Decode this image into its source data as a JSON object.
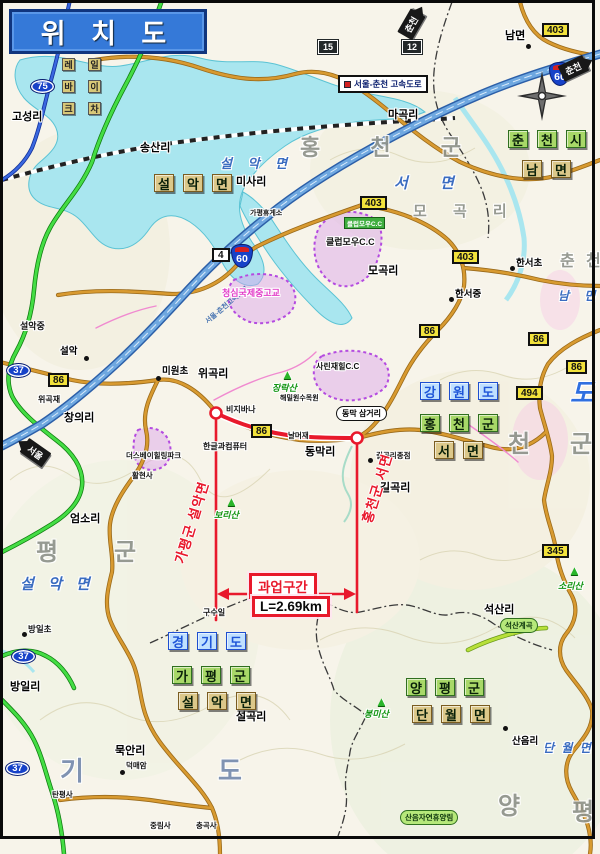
{
  "title": "위 치 도",
  "legend": {
    "expressway_label": "서울-춘천 고속도로",
    "expressway_inline": "서울-춘천고속도로"
  },
  "arrows": {
    "chuncheon": "춘천",
    "seoul": "서울"
  },
  "badges": {
    "n403": "403",
    "n15": "15",
    "n12": "12",
    "n75": "75",
    "n60": "60",
    "n4": "4",
    "n86": "86",
    "n494": "494",
    "n345": "345",
    "n37": "37"
  },
  "project": {
    "section": "과업구간",
    "length": "L=2.69km",
    "left_boundary": "가평군 설악면",
    "right_boundary": "홍천군 서면"
  },
  "regions": {
    "gangwon": [
      "강",
      "원",
      "도"
    ],
    "gyeonggi": [
      "경",
      "기",
      "도"
    ],
    "chuncheonsi": [
      "춘",
      "천",
      "시"
    ],
    "hongcheongun": [
      "홍",
      "천",
      "군"
    ],
    "gapyeonggun": [
      "가",
      "평",
      "군"
    ],
    "yangpyeonggun": [
      "양",
      "평",
      "군"
    ],
    "seomyeon": [
      "서",
      "면"
    ],
    "nammyeon": [
      "남",
      "면"
    ],
    "seorakmyeon": [
      "설",
      "악",
      "면"
    ],
    "danwolmyeon": [
      "단",
      "월",
      "면"
    ]
  },
  "spread": {
    "hongcheongun": "홍 천 군",
    "seomyeon": "서 면",
    "mogokri": "모 곡 리",
    "pyeong": "평",
    "gun": "군",
    "cheon": "천",
    "gun2": "군",
    "chun": "춘",
    "cheon2": "천",
    "nammyeon": "남 면",
    "do_blue": "도",
    "gi": "기",
    "do": "도",
    "yang": "양",
    "pyeong2": "평",
    "seorakmyeon_blue": "설 악 면",
    "seorakmyeon_left": "설 악 면",
    "danwolmyeon_blue": "단 월 면"
  },
  "places": {
    "bagam": "박암리",
    "nammyeon_dot": "남면",
    "goseong": "고성리",
    "songsan": "송산리",
    "misa": "미사리",
    "magok": "마곡리",
    "mogok": "모곡리",
    "hanseo_e": "한서초",
    "hanseo_m": "한서중",
    "wigok": "위곡리",
    "changui": "창의리",
    "miwon_e": "미원초",
    "eomso": "엄소리",
    "dongmak": "동막리",
    "gilgok": "길곡리",
    "gusuil": "구수일",
    "seoksan": "석산리",
    "saneum": "산음리",
    "seolgok": "설곡리",
    "mukan": "묵안리",
    "bangil": "방일리",
    "bangil_e": "방일초",
    "seorak_m": "설악중",
    "seorak": "설악",
    "bijibana": "비지바나",
    "hangeul": "한글과컴퓨터",
    "thespa": "더스베이힐링파크",
    "hwalhyeonsa": "활현사",
    "haemilwon": "해밀원수목원",
    "sarinjaehil": "사린재힐C.C",
    "clubmow": "클럽모우C.C",
    "cheongsim": "청심국제중고교",
    "wigokjae": "위곡재",
    "nalmeojae": "날머재",
    "dongmak3": "동막 삼거리",
    "gilgok_end": "길곡리종점",
    "seoksan_valley": "석산계곡",
    "saneum_forest": "산음자연휴양림",
    "deokmaeam": "덕매암",
    "jungnimsa": "중림사",
    "chunggoksa": "충곡사",
    "tanpyeongsa": "탄평사",
    "gapyeong_rest": "가평휴게소",
    "rail1": "레",
    "rail2": "일",
    "rail3": "바",
    "rail4": "이",
    "rail5": "크",
    "rail6": "차"
  },
  "mountains": {
    "jangnak": "장락산",
    "bori": "보리산",
    "sori": "소리산",
    "bongmi": "봉미산"
  }
}
